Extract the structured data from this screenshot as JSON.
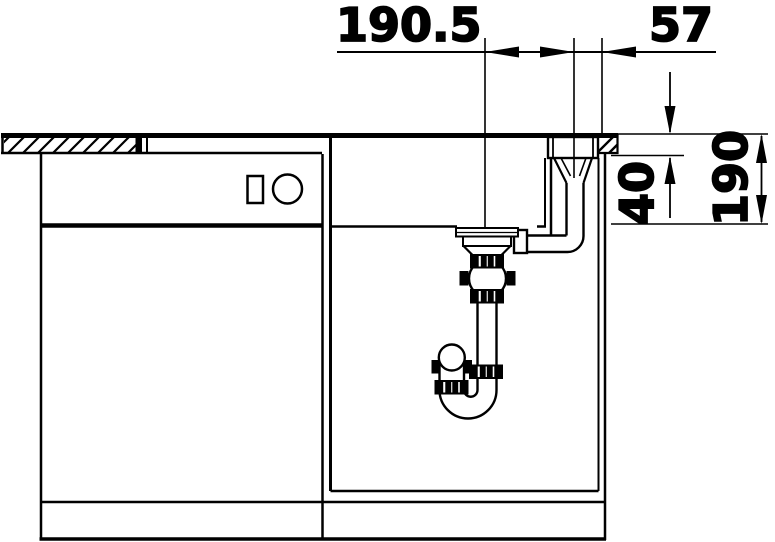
{
  "diagram": {
    "background": "#ffffff",
    "ink": "#000000",
    "dimension_labels": {
      "drain_to_overflow": "190.5",
      "overflow_to_counter_edge": "57",
      "countertop_thickness": "40",
      "bowl_depth": "190"
    }
  }
}
